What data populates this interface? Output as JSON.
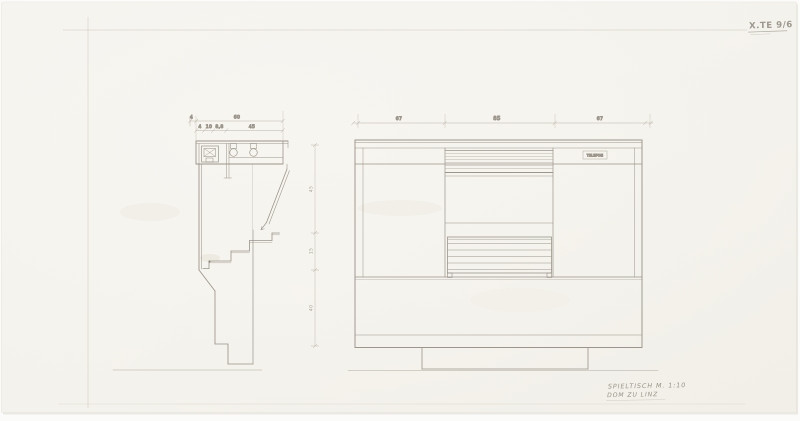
{
  "sheet": {
    "stamp": "X.TE 9/6",
    "title_line1": "SPIELTISCH M. 1:10",
    "title_line2": "DOM ZU LINZ"
  },
  "section_view": {
    "dim_row1": [
      "4",
      "60"
    ],
    "dim_row2": [
      "4",
      "10",
      "8,8",
      "45"
    ],
    "vertical_dims": [
      "45",
      "15",
      "40"
    ]
  },
  "elevation_view": {
    "dim_top": [
      "67",
      "85",
      "67"
    ],
    "panel_label": "TELEFON"
  }
}
